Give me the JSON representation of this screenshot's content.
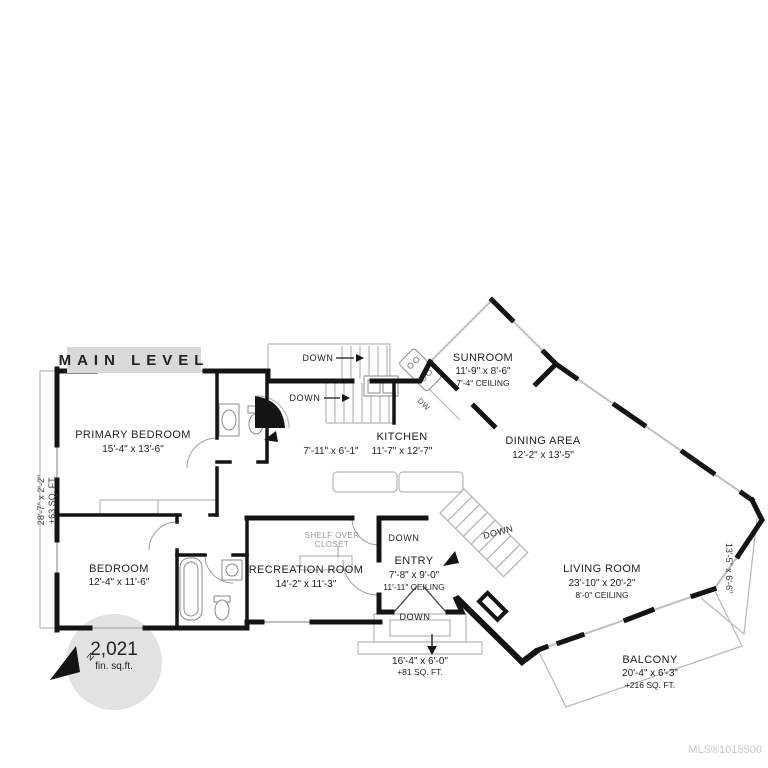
{
  "header": {
    "label": "MAIN LEVEL"
  },
  "rooms": {
    "primary_bedroom": {
      "name": "PRIMARY BEDROOM",
      "dims": "15'-4\" x 13'-6\""
    },
    "bedroom": {
      "name": "BEDROOM",
      "dims": "12'-4\" x 11'-6\""
    },
    "recreation_room": {
      "name": "RECREATION ROOM",
      "dims": "14'-2\" x 11'-3\""
    },
    "entry": {
      "name": "ENTRY",
      "dims": "7'-8\" x 9'-0\"",
      "ceiling": "11'-11\" CEILING"
    },
    "kitchen": {
      "name": "KITCHEN",
      "dims": "11'-7\" x 12'-7\""
    },
    "hall": {
      "dims": "7'-11\" x 6'-1\""
    },
    "sunroom": {
      "name": "SUNROOM",
      "dims": "11'-9\" x 8'-6\"",
      "ceiling": "7'-4\" CEILING"
    },
    "dining_area": {
      "name": "DINING AREA",
      "dims": "12'-2\" x 13'-5\""
    },
    "living_room": {
      "name": "LIVING ROOM",
      "dims": "23'-10\" x 20'-2\"",
      "ceiling": "8'-0\" CEILING"
    },
    "balcony": {
      "name": "BALCONY",
      "dims": "20'-4\" x 6'-3\"",
      "area": "+216 SQ. FT."
    }
  },
  "exterior": {
    "front_steps": {
      "dims": "16'-4\" x 6'-0\"",
      "area": "+81 SQ. FT."
    },
    "left_deck": {
      "dims": "28'-7\" x 2'-2\"",
      "area": "+63 SQ. FT."
    },
    "right_deck": {
      "dims": "13'-5\" x 6'-6\""
    }
  },
  "labels": {
    "down": "DOWN",
    "dw": "DW",
    "shelf_over": "SHELF OVER",
    "closet": "CLOSET",
    "north": "N"
  },
  "area_badge": {
    "value": "2,021",
    "unit": "fin. sq.ft."
  },
  "footer": {
    "mls": "MLS®1015500"
  },
  "colors": {
    "wall": "#141414",
    "window": "#bfbfbf",
    "thin_outline": "#b8b8b8",
    "label_text": "#222222",
    "muted_text": "#9a9a9a",
    "header_bg": "#d9d9d9",
    "badge_bg": "#e2e2e2",
    "mls_text": "#c9c9c9"
  }
}
